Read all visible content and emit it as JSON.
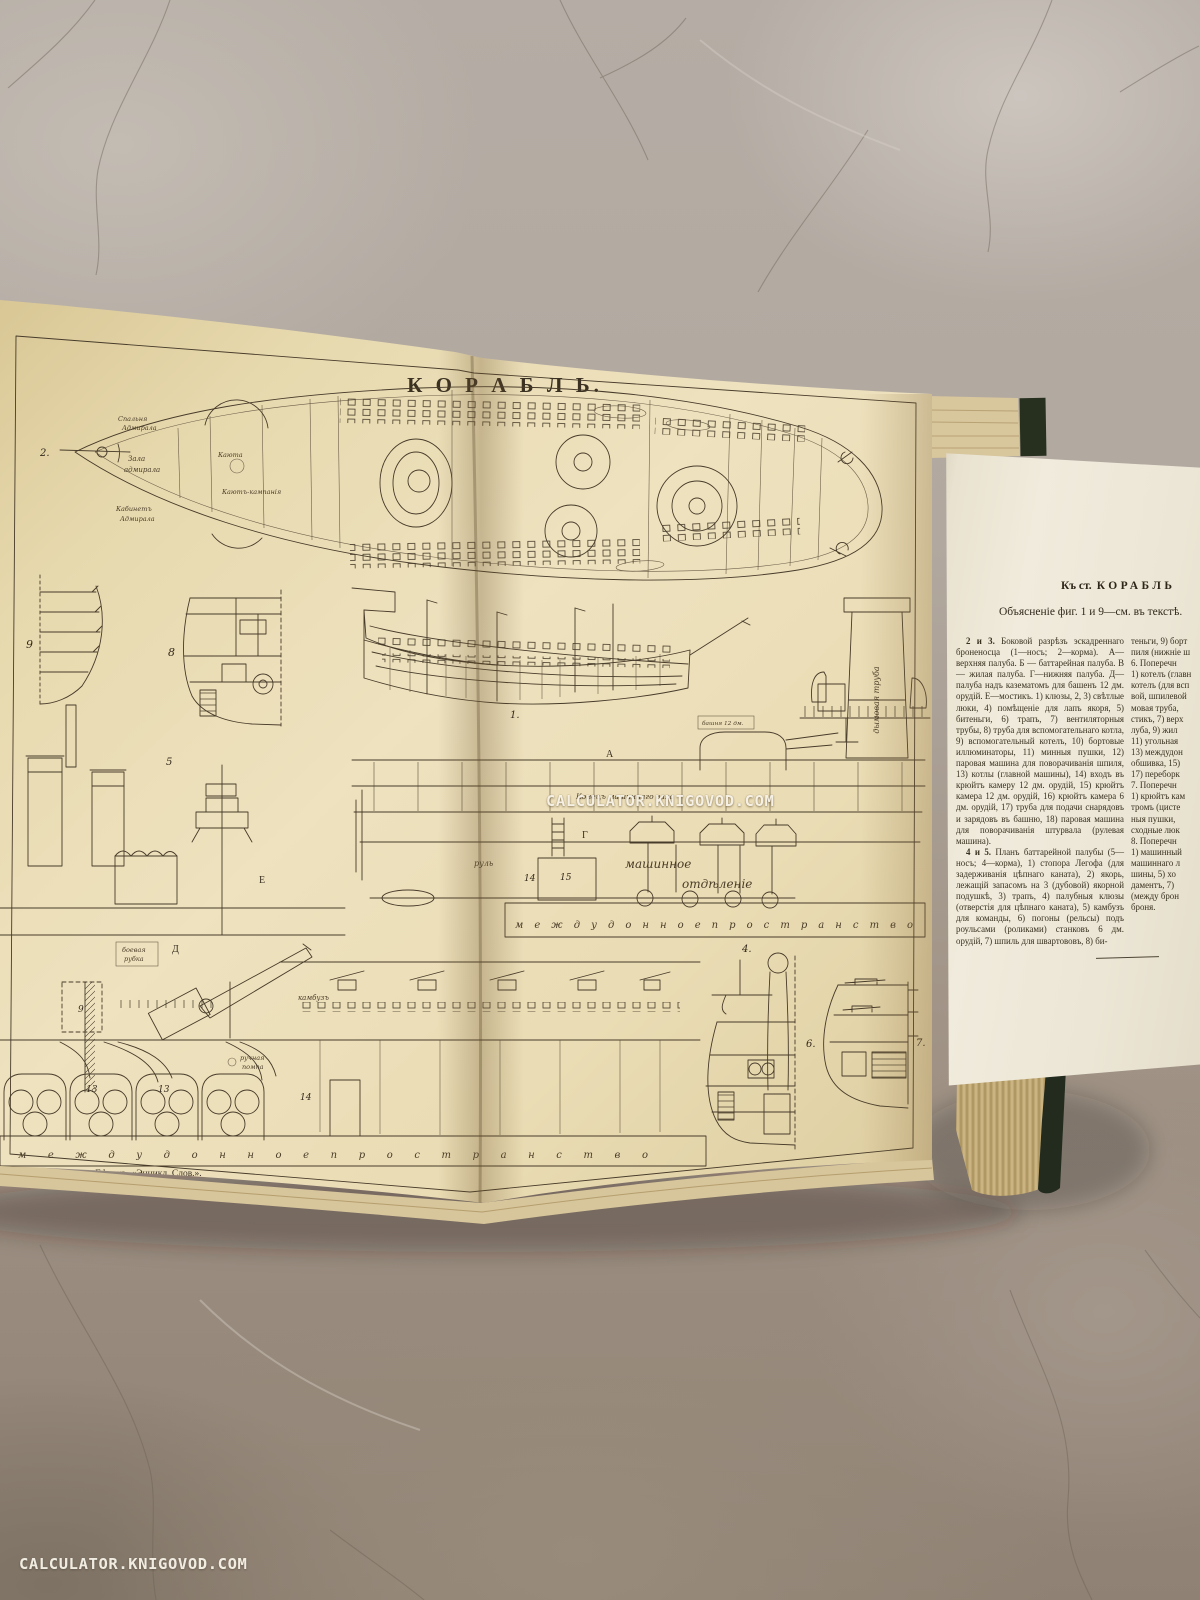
{
  "watermark": {
    "center": "CALCULATOR.KNIGOVOD.COM",
    "bottom_left": "CALCULATOR.KNIGOVOD.COM"
  },
  "plate": {
    "title": "К О Р А Б Л Ь.",
    "caption_publisher": "Брокгаузъ и Ефронъ, «Энцикл. Слов.».",
    "caption_printer": "Спб., Тип. Ефрона.",
    "labels": {
      "double_bottom": "м е ж д у д о н н о е   п р о с т р а н с т в о",
      "engine_room_l1": "машинное",
      "engine_room_l2": "отдѣленіе",
      "funnel": "дымовая труба",
      "rudder": "руль",
      "shaft_end": "Конецъ машиннаго вала",
      "turret": "башня 12 дм.",
      "conning_l1": "боевая",
      "conning_l2": "рубка",
      "pump_l1": "ручная",
      "pump_l2": "помпа",
      "galley": "камбузъ",
      "adm_bedroom_l1": "Спальня",
      "adm_bedroom_l2": "Адмирала",
      "adm_hall_l1": "Зала",
      "adm_hall_l2": "адмирала",
      "adm_cabinet_l1": "Кабинетъ",
      "adm_cabinet_l2": "Адмирала",
      "cabin": "Каюта",
      "wardroom": "Каютъ-кампанія",
      "deck_A": "А",
      "deck_G": "Г",
      "deck_E": "Е",
      "deck_D": "Д"
    },
    "figures": {
      "f1": "1.",
      "f2": "2.",
      "f4": "4.",
      "f5": "5",
      "f6": "6.",
      "f7": "7.",
      "f8": "8",
      "f9": "9",
      "n9": "9",
      "n13": "13",
      "n14": "14",
      "n15": "15"
    }
  },
  "insert_page": {
    "header_prefix": "Къ ст.",
    "header_title": "КОРАБЛЬ",
    "subheader": "Объясненіе фиг. 1 и 9—см. въ текстѣ.",
    "col1_p1_lead": "2 и 3.",
    "col1_p1": " Боковой разрѣзъ эскадреннаго броненосца (1—носъ; 2—корма). А—верхняя палуба. Б — баттарейная палуба. В — жилая палуба. Г—нижняя палуба. Д—палуба надъ казематомъ для башенъ 12 дм. орудій. Е—мостикъ. 1) клюзы, 2, 3) свѣтлые люки, 4) помѣщеніе для лапъ якоря, 5) битеньги, 6) трапъ, 7) вентиляторныя трубы, 8) труба для вспомогательнаго котла, 9) вспомогательный котелъ, 10) бортовые иллюминаторы, 11) минныя пушки, 12) паровая машина для поворачиванія шпиля, 13) котлы (главной машины), 14) входъ въ крюйтъ камеру 12 дм. орудій, 15) крюйтъ камера 12 дм. орудій, 16) крюйтъ камера 6 дм. орудій, 17) труба для подачи снарядовъ и зарядовъ въ башню, 18) паровая машина для поворачиванія штурвала (рулевая машина).",
    "col1_p2_lead": "4 и 5.",
    "col1_p2": " Планъ баттарейной палубы (5—носъ; 4—корма), 1) стопора Легофа (для задерживанія цѣпнаго каната), 2) якорь, лежащій запасомъ на 3 (дубовой) якорной подушкѣ, 3) трапъ, 4) палубныя клюзы (отверстія для цѣпнаго каната), 5) камбузъ для команды, 6) погоны (рельсы) подъ роульсами (роликами) станковъ 6 дм. орудій, 7) шпиль для швартововъ, 8) би-",
    "col2_lines": [
      "теньги, 9) борт",
      "пиля (нижніе ш",
      "6. Поперечн",
      "1) котелъ (главн",
      "котелъ (для всп",
      "вой, шпилевой",
      "мовая труба,",
      "стикъ, 7) верх",
      "луба, 9) жил",
      "11) угольная",
      "13) междудон",
      "обшивка, 15)",
      "17) переборк",
      "7. Поперечн",
      "1) крюйтъ кам",
      "тромъ (цисте",
      "ныя пушки,",
      "сходные люк",
      "8. Поперечн",
      "1) машинный",
      "машиннаго л",
      "шины, 5) хо",
      "даментъ, 7)",
      "(между брон",
      "броня."
    ]
  }
}
